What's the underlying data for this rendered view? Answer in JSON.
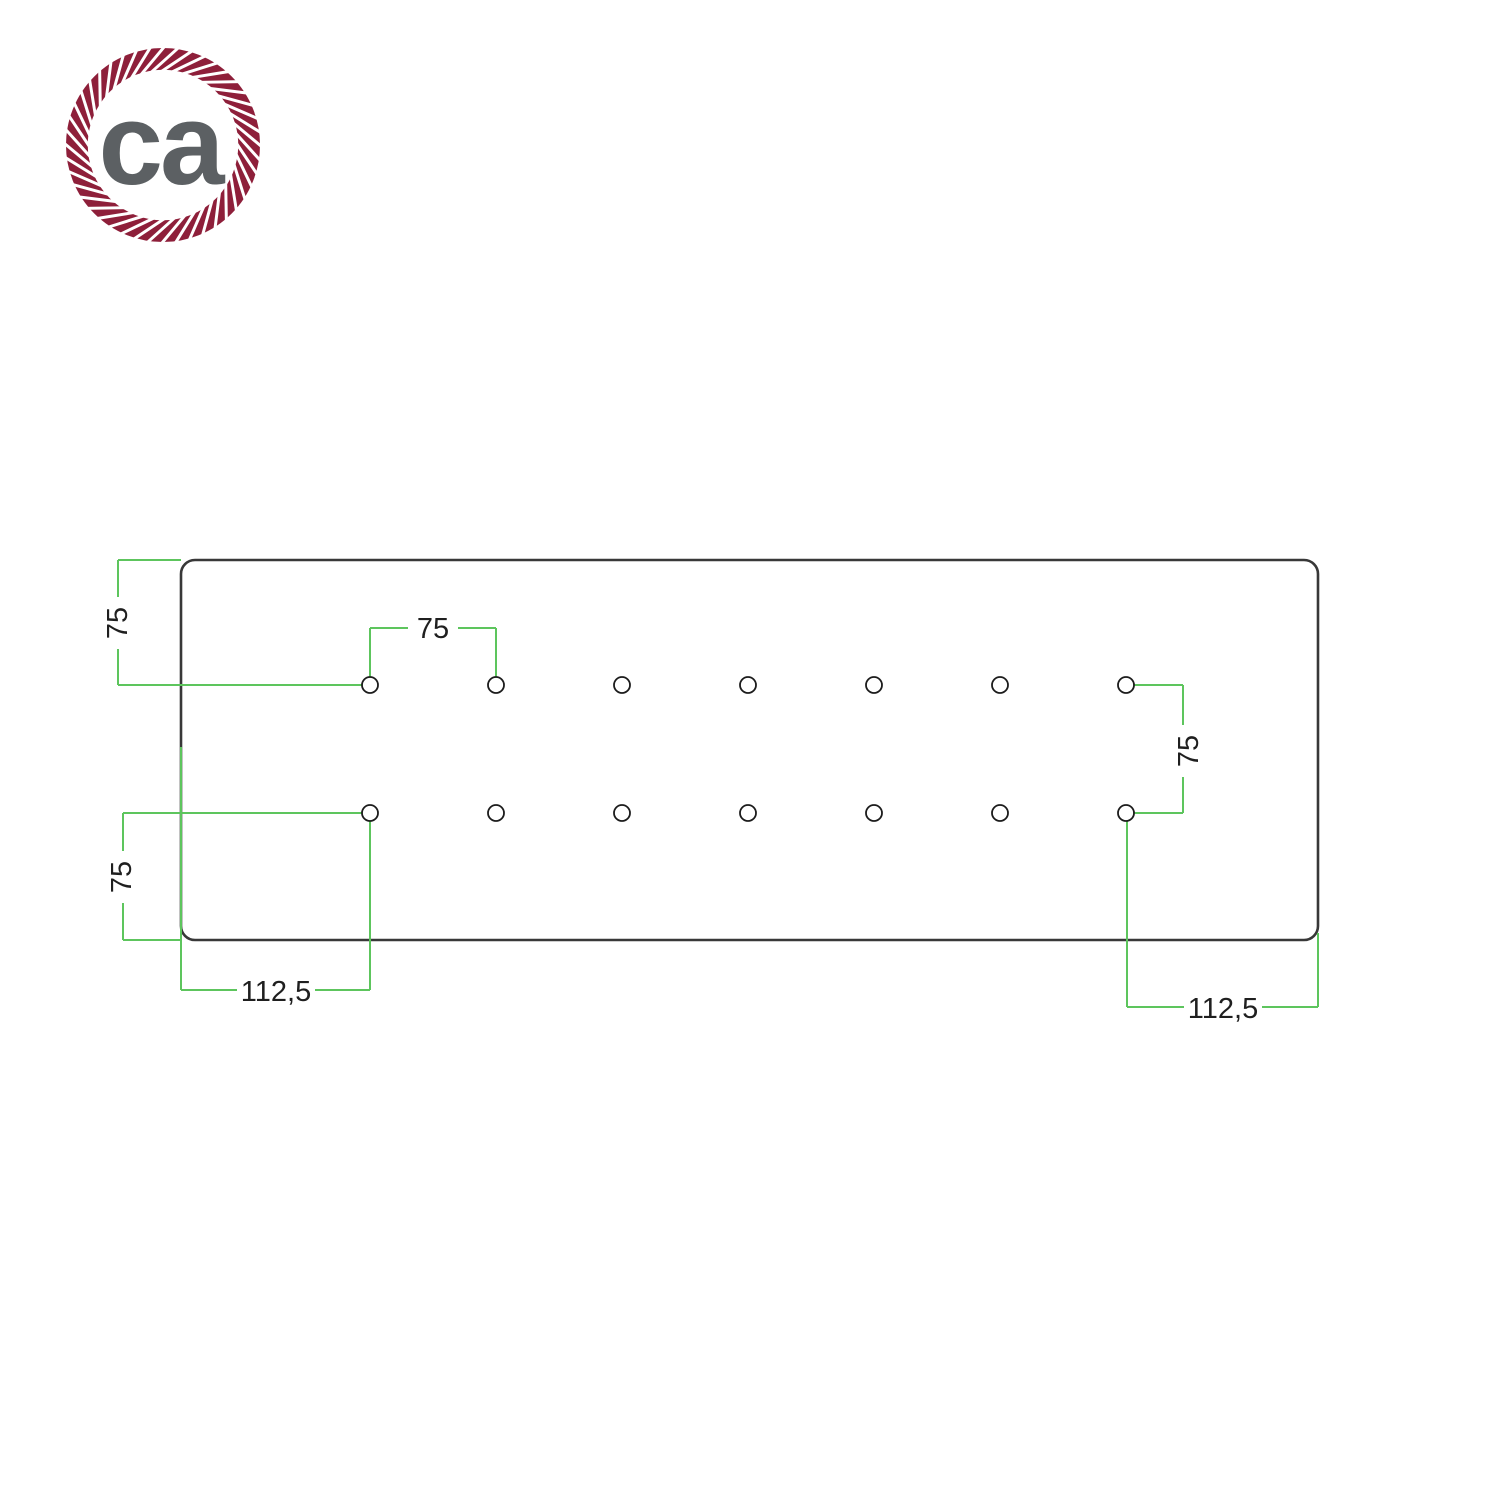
{
  "logo": {
    "text": "ca",
    "rope_color": "#8e1f3a",
    "text_color": "#5c6063"
  },
  "drawing": {
    "colors": {
      "dimension": "#5dc55d",
      "plate_outline": "#383838",
      "hole_outline": "#1c1c1c",
      "label_text": "#1f1f1f"
    },
    "dimensions": {
      "top_left_vertical_label": "75",
      "top_hole_spacing_label": "75",
      "right_row_spacing_label": "75",
      "bottom_left_vertical_label": "75",
      "bottom_left_offset_label": "112,5",
      "bottom_right_offset_label": "112,5"
    },
    "holes": {
      "count": 14,
      "rows": 2,
      "columns": 7,
      "columns_x": [
        370,
        496,
        622,
        748,
        874,
        1000,
        1126
      ],
      "rows_y": [
        685,
        813
      ],
      "radius": 8
    }
  }
}
